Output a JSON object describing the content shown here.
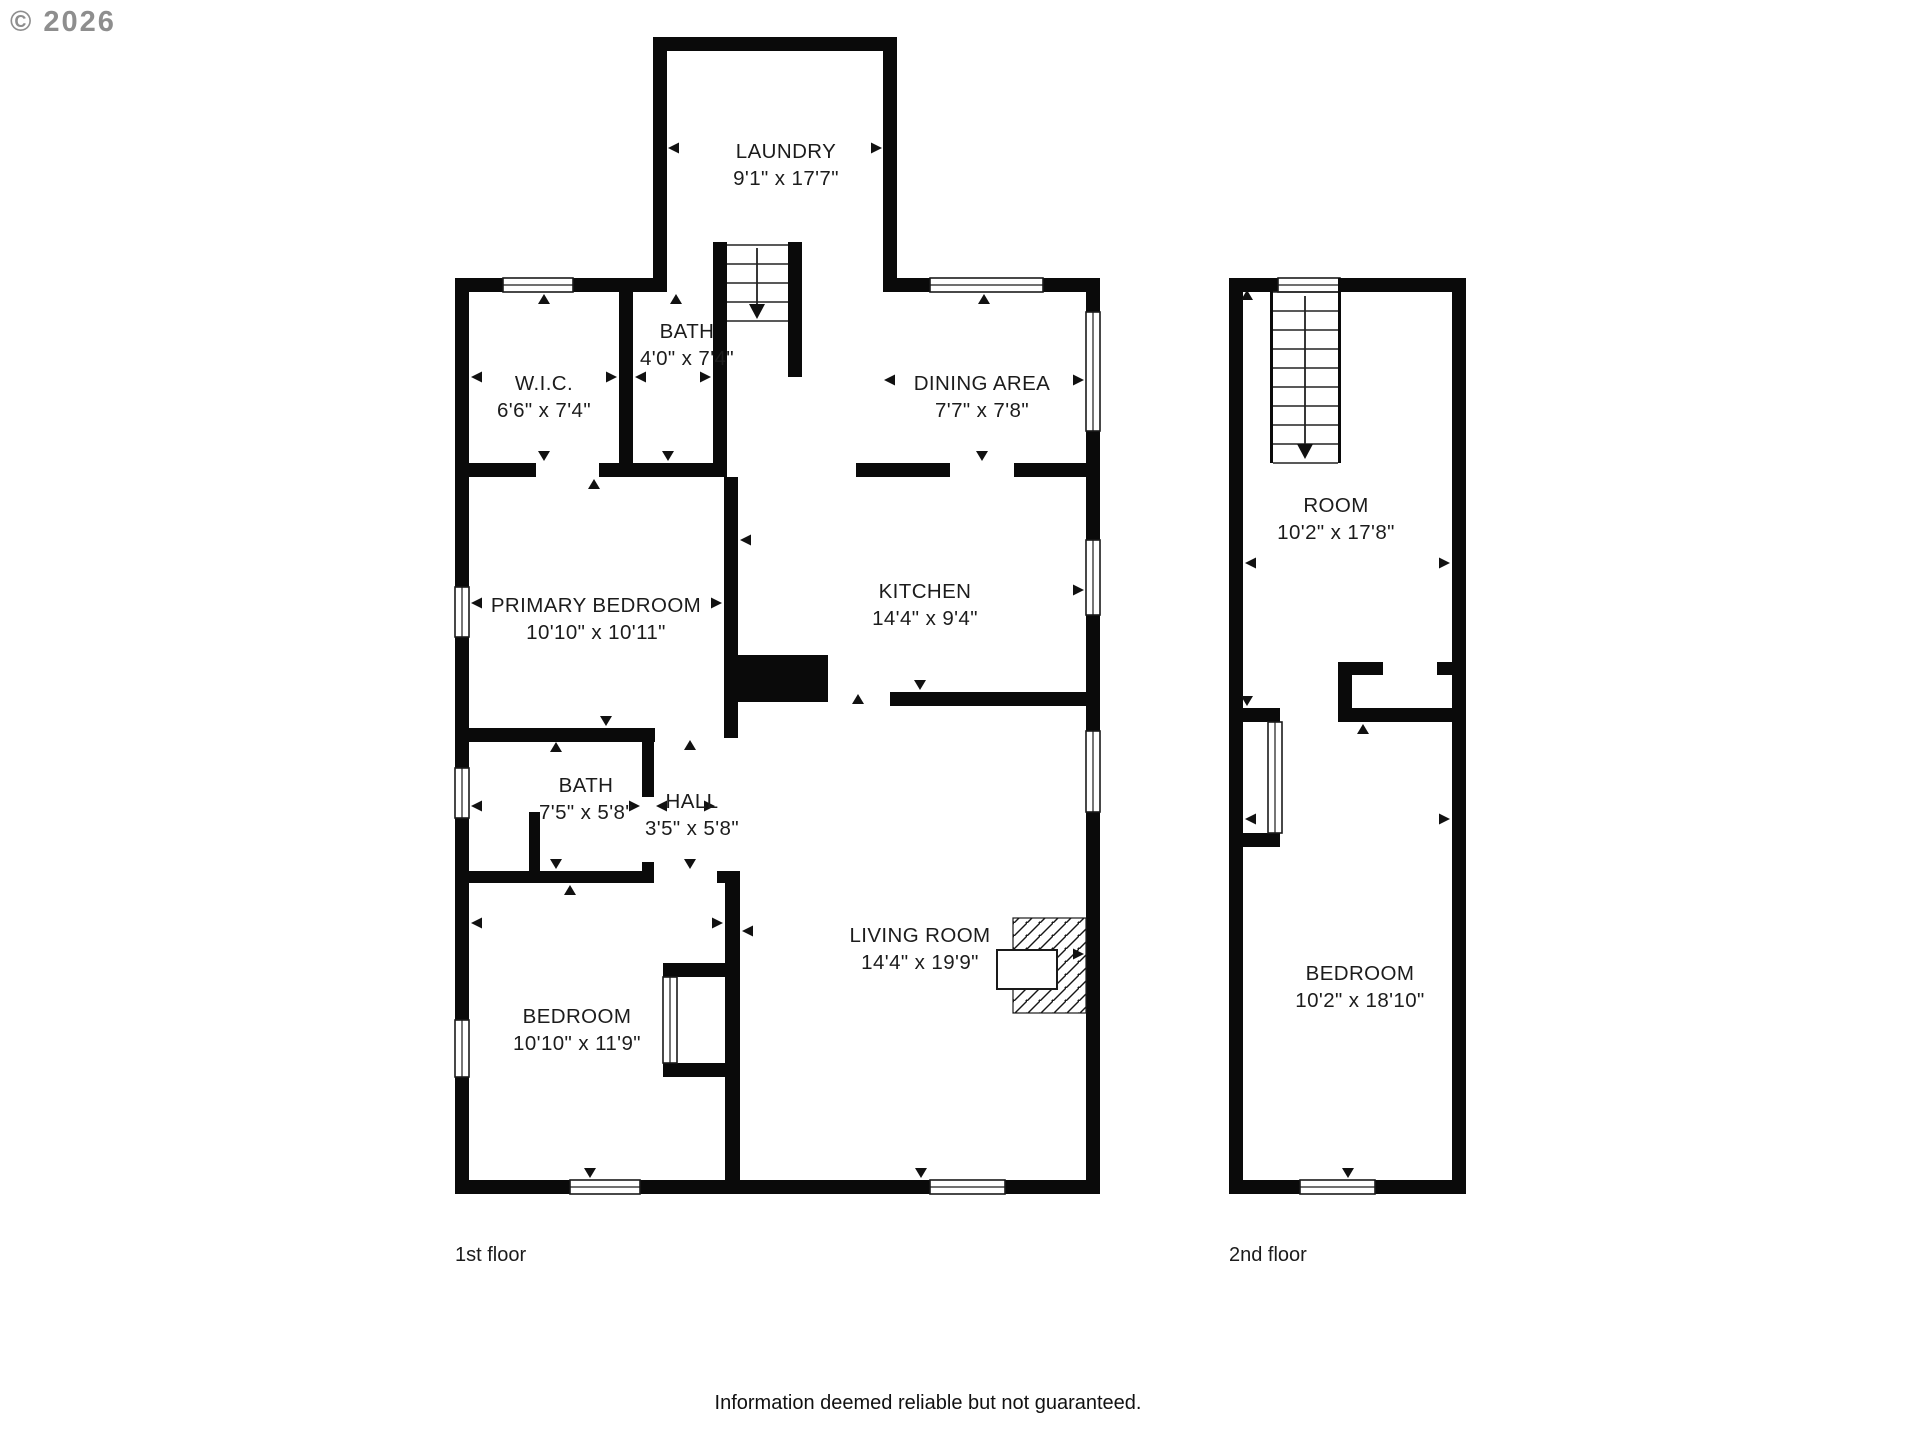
{
  "watermark": "© 2026",
  "footer": {
    "text": "Information deemed reliable but not guaranteed."
  },
  "floors": [
    {
      "label": "1st floor"
    },
    {
      "label": "2nd floor"
    }
  ],
  "rooms": [
    {
      "name": "LAUNDRY",
      "dims": "9'1\" x 17'7\"",
      "cx": 786,
      "cy": 158
    },
    {
      "name": "BATH",
      "dims": "4'0\" x 7'4\"",
      "cx": 687,
      "cy": 338
    },
    {
      "name": "W.I.C.",
      "dims": "6'6\" x 7'4\"",
      "cx": 544,
      "cy": 390
    },
    {
      "name": "DINING AREA",
      "dims": "7'7\" x 7'8\"",
      "cx": 982,
      "cy": 390
    },
    {
      "name": "KITCHEN",
      "dims": "14'4\" x 9'4\"",
      "cx": 925,
      "cy": 598
    },
    {
      "name": "PRIMARY BEDROOM",
      "dims": "10'10\" x 10'11\"",
      "cx": 596,
      "cy": 612
    },
    {
      "name": "BATH",
      "dims": "7'5\" x 5'8\"",
      "cx": 586,
      "cy": 792
    },
    {
      "name": "HALL",
      "dims": "3'5\" x 5'8\"",
      "cx": 692,
      "cy": 808
    },
    {
      "name": "LIVING ROOM",
      "dims": "14'4\" x 19'9\"",
      "cx": 920,
      "cy": 942
    },
    {
      "name": "BEDROOM",
      "dims": "10'10\" x 11'9\"",
      "cx": 577,
      "cy": 1023
    },
    {
      "name": "ROOM",
      "dims": "10'2\" x 17'8\"",
      "cx": 1336,
      "cy": 512
    },
    {
      "name": "BEDROOM",
      "dims": "10'2\" x 18'10\"",
      "cx": 1360,
      "cy": 980
    }
  ],
  "geometry": {
    "wall_color": "#0a0a0a",
    "line_color": "#1a1a1a",
    "walls": [
      [
        653,
        37,
        244,
        14
      ],
      [
        653,
        37,
        14,
        255
      ],
      [
        883,
        37,
        14,
        255
      ],
      [
        455,
        278,
        212,
        14
      ],
      [
        897,
        278,
        189,
        14
      ],
      [
        455,
        278,
        14,
        916
      ],
      [
        1086,
        278,
        14,
        916
      ],
      [
        455,
        1180,
        645,
        14
      ],
      [
        619,
        292,
        14,
        171
      ],
      [
        455,
        463,
        272,
        14
      ],
      [
        713,
        242,
        14,
        221
      ],
      [
        788,
        242,
        14,
        135
      ],
      [
        856,
        463,
        230,
        14
      ],
      [
        724,
        477,
        14,
        261
      ],
      [
        731,
        655,
        97,
        47
      ],
      [
        890,
        692,
        196,
        14
      ],
      [
        455,
        728,
        200,
        14
      ],
      [
        642,
        728,
        12,
        155
      ],
      [
        529,
        812,
        11,
        71
      ],
      [
        455,
        871,
        199,
        12
      ],
      [
        717,
        871,
        23,
        12
      ],
      [
        725,
        877,
        15,
        303
      ],
      [
        663,
        963,
        77,
        14
      ],
      [
        663,
        1063,
        77,
        14
      ],
      [
        1229,
        278,
        237,
        14
      ],
      [
        1229,
        278,
        14,
        916
      ],
      [
        1452,
        278,
        14,
        916
      ],
      [
        1229,
        1180,
        237,
        14
      ],
      [
        1229,
        708,
        51,
        14
      ],
      [
        1229,
        833,
        51,
        14
      ],
      [
        1338,
        662,
        14,
        60
      ],
      [
        1338,
        662,
        45,
        13
      ],
      [
        1437,
        662,
        15,
        13
      ],
      [
        1338,
        708,
        114,
        14
      ]
    ],
    "gaps": [
      [
        536,
        463,
        63,
        14
      ],
      [
        950,
        463,
        64,
        14
      ],
      [
        642,
        797,
        12,
        65
      ]
    ],
    "windows": [
      [
        503,
        278,
        70,
        14
      ],
      [
        930,
        278,
        113,
        14
      ],
      [
        455,
        587,
        14,
        50
      ],
      [
        455,
        768,
        14,
        50
      ],
      [
        455,
        1020,
        14,
        57
      ],
      [
        1086,
        312,
        14,
        119
      ],
      [
        1086,
        540,
        14,
        75
      ],
      [
        1086,
        731,
        14,
        81
      ],
      [
        570,
        1180,
        70,
        14
      ],
      [
        930,
        1180,
        75,
        14
      ],
      [
        1278,
        278,
        62,
        14
      ],
      [
        1300,
        1180,
        75,
        14
      ]
    ],
    "closet_doors": [
      [
        663,
        977,
        14,
        86
      ],
      [
        1268,
        722,
        14,
        111
      ]
    ],
    "stairs": [
      {
        "rails": [],
        "x1": 727,
        "x2": 788,
        "treads": [
          245,
          264,
          283,
          302,
          321
        ],
        "center_x": 757,
        "arrow_y1": 248,
        "arrow_y2": 304
      },
      {
        "rails": [
          [
            1270,
            278,
            3,
            185
          ],
          [
            1338,
            278,
            3,
            185
          ]
        ],
        "x1": 1273,
        "x2": 1338,
        "treads": [
          292,
          311,
          330,
          349,
          368,
          387,
          406,
          425,
          444,
          463
        ],
        "center_x": 1305,
        "arrow_y1": 296,
        "arrow_y2": 444
      }
    ],
    "fireplace": {
      "hatch": [
        1013,
        918,
        73,
        95
      ],
      "firebox": [
        997,
        950,
        60,
        39
      ]
    },
    "markers": [
      [
        668,
        148,
        "left"
      ],
      [
        882,
        148,
        "right"
      ],
      [
        471,
        377,
        "left"
      ],
      [
        617,
        377,
        "right"
      ],
      [
        544,
        294,
        "up"
      ],
      [
        544,
        461,
        "down"
      ],
      [
        635,
        377,
        "left"
      ],
      [
        711,
        377,
        "right"
      ],
      [
        676,
        294,
        "up"
      ],
      [
        668,
        461,
        "down"
      ],
      [
        884,
        380,
        "left"
      ],
      [
        1084,
        380,
        "right"
      ],
      [
        984,
        294,
        "up"
      ],
      [
        982,
        461,
        "down"
      ],
      [
        740,
        540,
        "left"
      ],
      [
        1084,
        590,
        "right"
      ],
      [
        920,
        690,
        "down"
      ],
      [
        471,
        603,
        "left"
      ],
      [
        722,
        603,
        "right"
      ],
      [
        594,
        479,
        "up"
      ],
      [
        606,
        726,
        "down"
      ],
      [
        471,
        806,
        "left"
      ],
      [
        640,
        806,
        "right"
      ],
      [
        556,
        742,
        "up"
      ],
      [
        556,
        869,
        "down"
      ],
      [
        656,
        806,
        "left"
      ],
      [
        715,
        806,
        "right"
      ],
      [
        690,
        740,
        "up"
      ],
      [
        690,
        869,
        "down"
      ],
      [
        742,
        931,
        "left"
      ],
      [
        1084,
        954,
        "right"
      ],
      [
        858,
        694,
        "up"
      ],
      [
        921,
        1178,
        "down"
      ],
      [
        471,
        923,
        "left"
      ],
      [
        723,
        923,
        "right"
      ],
      [
        570,
        885,
        "up"
      ],
      [
        590,
        1178,
        "down"
      ],
      [
        1247,
        290,
        "up"
      ],
      [
        1247,
        706,
        "down"
      ],
      [
        1245,
        563,
        "left"
      ],
      [
        1450,
        563,
        "right"
      ],
      [
        1363,
        724,
        "up"
      ],
      [
        1245,
        819,
        "left"
      ],
      [
        1450,
        819,
        "right"
      ],
      [
        1348,
        1178,
        "down"
      ]
    ]
  }
}
